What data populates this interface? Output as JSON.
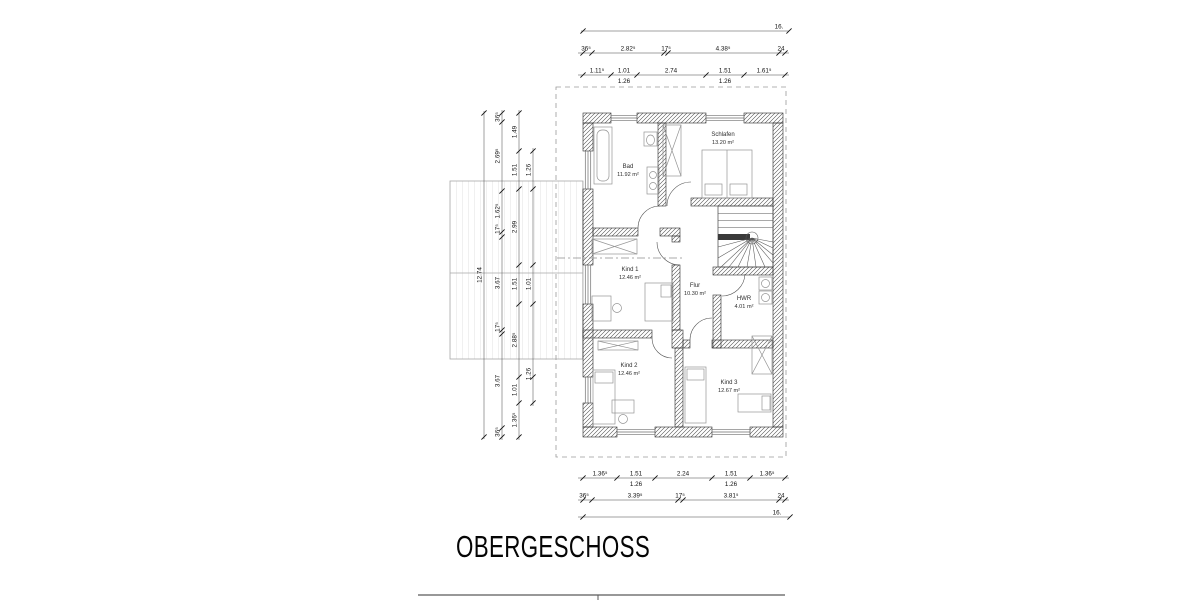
{
  "drawing_title": "OBERGESCHOSS",
  "plan": {
    "rooms": [
      {
        "name": "Bad",
        "area": "11.92 m²",
        "x": 628,
        "y": 168
      },
      {
        "name": "Schlafen",
        "area": "13.20 m²",
        "x": 723,
        "y": 136
      },
      {
        "name": "Kind 1",
        "area": "12.46 m²",
        "x": 630,
        "y": 271
      },
      {
        "name": "Flur",
        "area": "10.30 m²",
        "x": 695,
        "y": 287
      },
      {
        "name": "HWR",
        "area": "4.01 m²",
        "x": 744,
        "y": 300
      },
      {
        "name": "Kind 2",
        "area": "12.46 m²",
        "x": 629,
        "y": 367
      },
      {
        "name": "Kind 3",
        "area": "12.67 m²",
        "x": 729,
        "y": 384
      }
    ]
  },
  "dimension_chains": [
    {
      "o": "h",
      "y": 31,
      "x1": 581,
      "x2": 789,
      "ticks": [
        583,
        789
      ],
      "labels": [
        {
          "t": "16.",
          "x": 779
        }
      ]
    },
    {
      "o": "h",
      "y": 53,
      "x1": 578,
      "x2": 789,
      "ticks": [
        583,
        592,
        664,
        668,
        779,
        785
      ],
      "labels": [
        {
          "t": "36⁵",
          "x": 586
        },
        {
          "t": "2.82⁵",
          "x": 628
        },
        {
          "t": "17⁵",
          "x": 666
        },
        {
          "t": "4.38⁵",
          "x": 723
        },
        {
          "t": "24",
          "x": 781
        }
      ]
    },
    {
      "o": "h",
      "y": 75,
      "x1": 578,
      "x2": 789,
      "ticks": [
        583,
        611,
        637,
        706,
        744,
        785
      ],
      "labels": [
        {
          "t": "1.11⁵",
          "x": 597
        },
        {
          "t": "1.01",
          "x": 624
        },
        {
          "t": "2.74",
          "x": 671
        },
        {
          "t": "1.51",
          "x": 725
        },
        {
          "t": "1.61⁵",
          "x": 764
        }
      ],
      "below": [
        {
          "t": "1.26",
          "x": 624
        },
        {
          "t": "1.26",
          "x": 725
        }
      ]
    },
    {
      "o": "h",
      "y": 478,
      "x1": 578,
      "x2": 789,
      "ticks": [
        583,
        617,
        655,
        712,
        750,
        785
      ],
      "labels": [
        {
          "t": "1.36⁵",
          "x": 600
        },
        {
          "t": "1.51",
          "x": 636
        },
        {
          "t": "2.24",
          "x": 683
        },
        {
          "t": "1.51",
          "x": 731
        },
        {
          "t": "1.36⁵",
          "x": 767
        }
      ],
      "below": [
        {
          "t": "1.26",
          "x": 636
        },
        {
          "t": "1.26",
          "x": 731
        }
      ]
    },
    {
      "o": "h",
      "y": 500,
      "x1": 578,
      "x2": 789,
      "ticks": [
        583,
        592,
        678,
        683,
        779,
        785
      ],
      "labels": [
        {
          "t": "36⁵",
          "x": 584
        },
        {
          "t": "3.39⁵",
          "x": 635
        },
        {
          "t": "17⁵",
          "x": 680
        },
        {
          "t": "3.81⁵",
          "x": 731
        },
        {
          "t": "24",
          "x": 781
        }
      ]
    },
    {
      "o": "h",
      "y": 517,
      "x1": 578,
      "x2": 790,
      "ticks": [
        583,
        790
      ],
      "labels": [
        {
          "t": "16.",
          "x": 777
        }
      ]
    },
    {
      "o": "v",
      "x": 484,
      "y1": 111,
      "y2": 439,
      "ticks": [
        113,
        437
      ],
      "labels": [
        {
          "t": "12.74",
          "y": 275
        }
      ]
    },
    {
      "o": "v",
      "x": 502,
      "y1": 110,
      "y2": 440,
      "ticks": [
        113,
        122,
        191,
        232,
        237,
        330,
        334,
        428,
        437
      ],
      "labels": [
        {
          "t": "36⁵",
          "y": 117
        },
        {
          "t": "2.69⁵",
          "y": 156
        },
        {
          "t": "1.62⁵",
          "y": 211
        },
        {
          "t": "17⁵",
          "y": 229
        },
        {
          "t": "3.67",
          "y": 283
        },
        {
          "t": "17⁵",
          "y": 327
        },
        {
          "t": "3.67",
          "y": 381
        },
        {
          "t": "36⁵",
          "y": 432
        }
      ]
    },
    {
      "o": "v",
      "x": 519,
      "y1": 110,
      "y2": 440,
      "ticks": [
        113,
        151,
        189,
        265,
        304,
        377,
        403,
        437
      ],
      "labels": [
        {
          "t": "1.49",
          "y": 132
        },
        {
          "t": "1.51",
          "y": 170
        },
        {
          "t": "2.99",
          "y": 227
        },
        {
          "t": "1.51",
          "y": 284
        },
        {
          "t": "2.88⁵",
          "y": 340
        },
        {
          "t": "1.01",
          "y": 390
        },
        {
          "t": "1.36⁵",
          "y": 420
        }
      ]
    },
    {
      "o": "v",
      "x": 533,
      "y1": 148,
      "y2": 406,
      "ticks": [
        151,
        189,
        265,
        304,
        377,
        403
      ],
      "labels": [
        {
          "t": "1.26",
          "y": 170
        },
        {
          "t": "1.01",
          "y": 284
        },
        {
          "t": "1.26",
          "y": 374
        }
      ]
    }
  ]
}
